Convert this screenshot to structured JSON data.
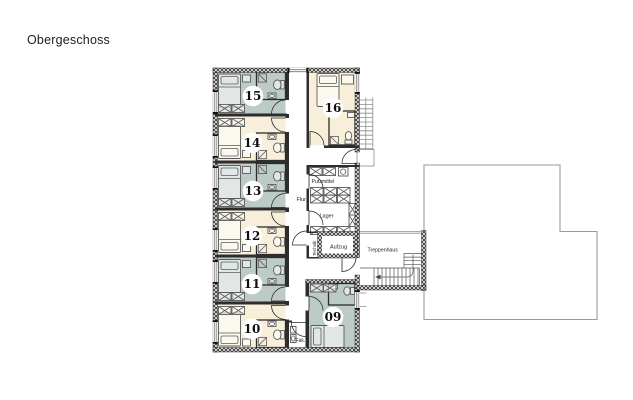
{
  "title": "Obergeschoss",
  "rooms": [
    {
      "number": "15",
      "color_type": "blue"
    },
    {
      "number": "14",
      "color_type": "cream"
    },
    {
      "number": "13",
      "color_type": "blue"
    },
    {
      "number": "12",
      "color_type": "cream"
    },
    {
      "number": "11",
      "color_type": "blue"
    },
    {
      "number": "10",
      "color_type": "cream"
    },
    {
      "number": "16",
      "color_type": "cream"
    },
    {
      "number": "09",
      "color_type": "blue"
    }
  ],
  "labels": {
    "flur": "Flur",
    "putzmittel": "Putzmittel",
    "lager": "Lager",
    "aufzug": "Aufzug",
    "technik": "Technik",
    "treppenhaus": "Treppenhaus",
    "faekalienraum": "Fäk."
  },
  "colors": {
    "room_blue": "#bccbc8",
    "room_cream": "#f7efd9",
    "wall_dark": "#2d2d2d",
    "outline": "#9a9a9a"
  }
}
